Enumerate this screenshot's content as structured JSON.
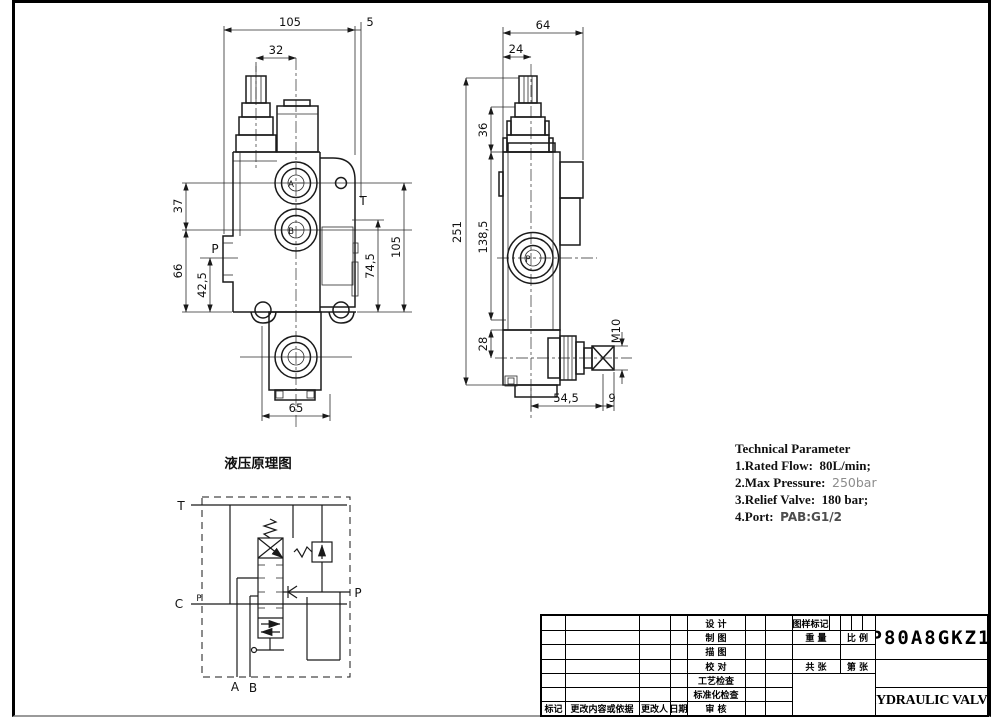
{
  "front_view": {
    "d105": "105",
    "d5": "5",
    "d32": "32",
    "d37": "37",
    "d66": "66",
    "d42_5": "42,5",
    "d105r": "105",
    "d74_5": "74,5",
    "d65": "65",
    "port_a": "A",
    "port_b": "B",
    "port_p": "P",
    "port_t": "T"
  },
  "side_view": {
    "d64": "64",
    "d24": "24",
    "d36": "36",
    "d251": "251",
    "d138_5": "138,5",
    "d28": "28",
    "thread": "M10",
    "d54_5": "54,5",
    "d9": "9",
    "port_p": "P"
  },
  "schematic": {
    "title": "液压原理图",
    "port_t": "T",
    "port_c": "C",
    "port_p": "P",
    "port_a": "A",
    "port_b": "B",
    "plug": "P"
  },
  "technical": {
    "title": "Technical Parameter",
    "line1_label": "1.Rated Flow:",
    "line1_value": "80L/min;",
    "line2_label": "2.Max Pressure:",
    "line2_value": "250bar",
    "line3_label": "3.Relief Valve:",
    "line3_value": "180 bar;",
    "line4_label": "4.Port:",
    "line4_value": "PAB:G1/2"
  },
  "title_block": {
    "part_number": "P80A8GKZ1",
    "product_title": "HYDRAULIC VALVE",
    "mid_rows": [
      "设 计",
      "制 图",
      "描 图",
      "校 对",
      "工艺检查",
      "标准化检查",
      "审 核"
    ],
    "drawing_mark": "图样标记",
    "weight": "重 量",
    "scale": "比 例",
    "total_sheets": "共 张",
    "sheet_no": "第 张",
    "mark": "标记",
    "change_content": "更改内容或依据",
    "changed_by": "更改人",
    "date": "日期"
  },
  "colors": {
    "line": "#1a1a1a",
    "gray_value": "#8c8c8c"
  }
}
